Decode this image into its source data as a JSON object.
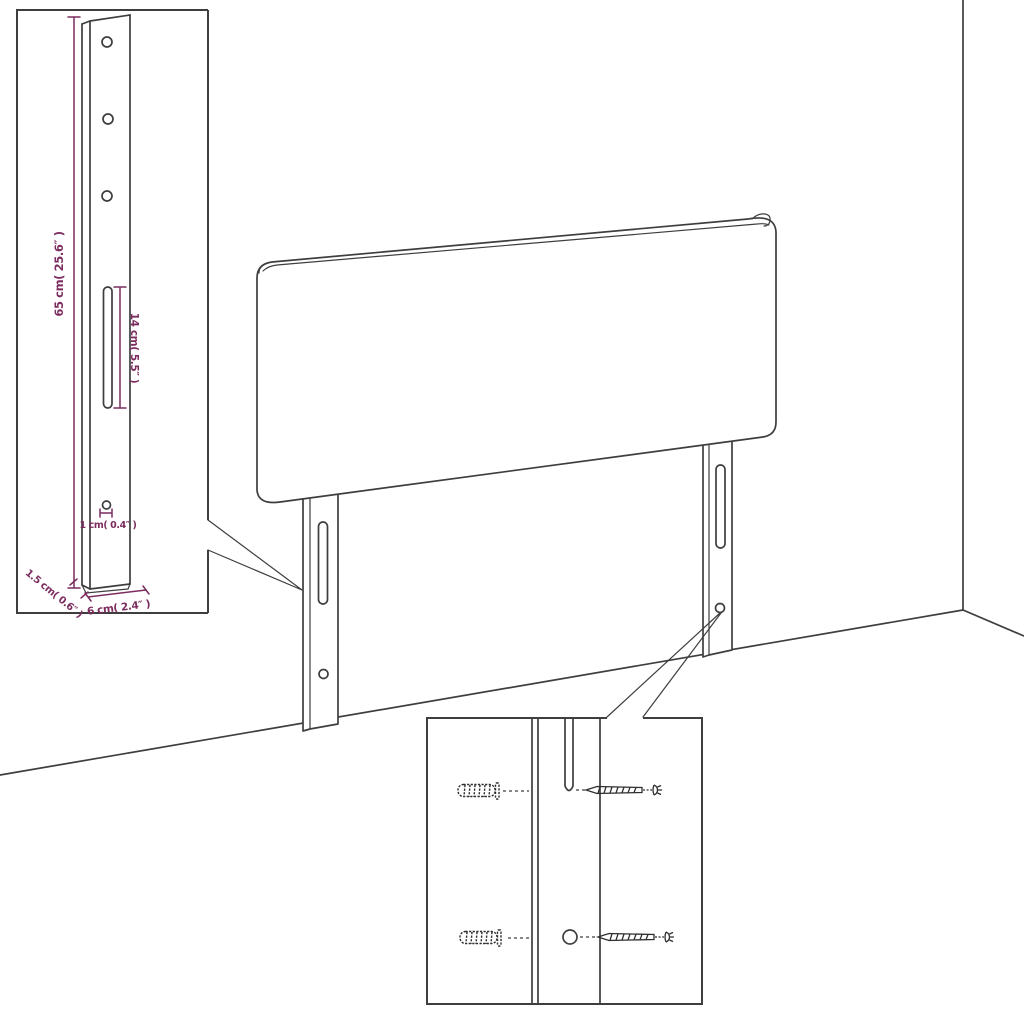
{
  "annotations": {
    "height": "65 cm( 25.6″ )",
    "slot": "14 cm( 5.5″ )",
    "hole": "1 cm( 0.4″ )",
    "depth": "1.5 cm( 0.6″ )",
    "width": "6 cm( 2.4″ )"
  },
  "colors": {
    "dimension": "#7B2D5F",
    "line": "#3E3E3E",
    "background": "#FFFFFF"
  }
}
